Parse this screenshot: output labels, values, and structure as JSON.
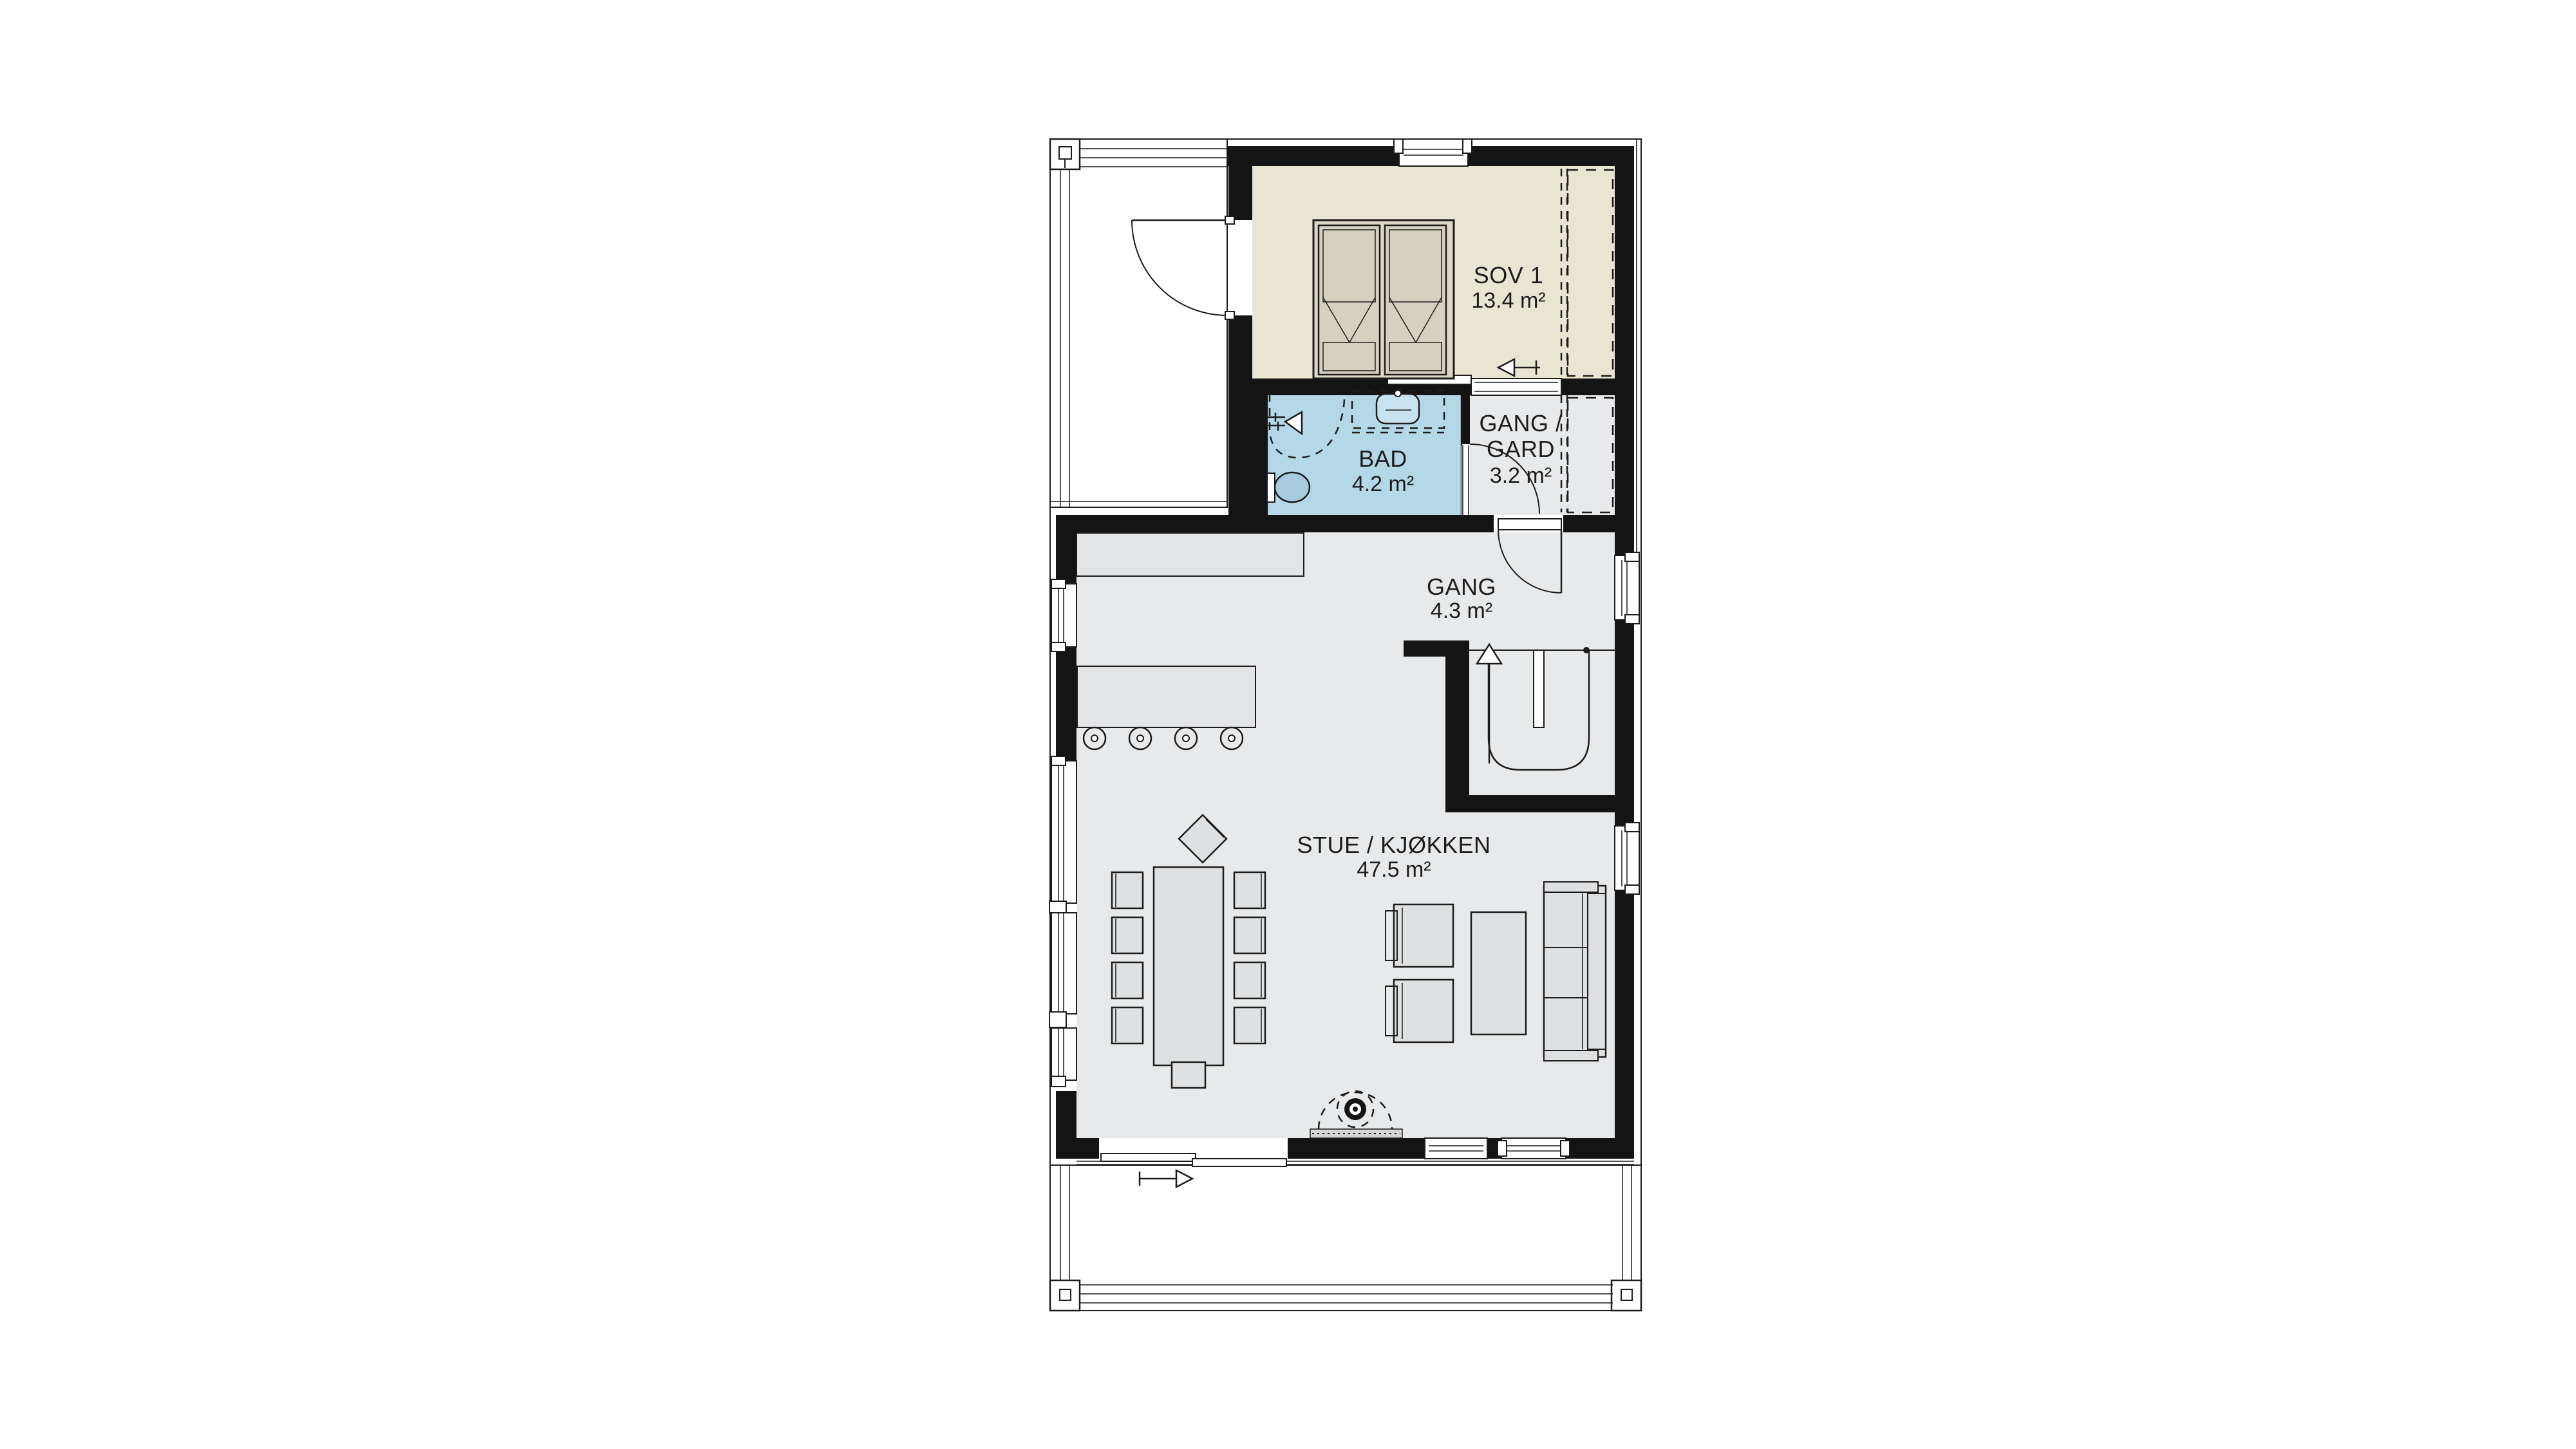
{
  "rooms": {
    "sov1": {
      "name": "SOV 1",
      "area": "13.4 m²"
    },
    "bad": {
      "name": "BAD",
      "area": "4.2 m²"
    },
    "gang_gard": {
      "name_line1": "GANG /",
      "name_line2": "GARD",
      "area": "3.2 m²"
    },
    "gang": {
      "name": "GANG",
      "area": "4.3 m²"
    },
    "stue_kjokken": {
      "name": "STUE / KJØKKEN",
      "area": "47.5 m²"
    }
  },
  "colors": {
    "background": "#ffffff",
    "wall": "#141414",
    "line": "#1c1c1c",
    "bedroom_floor": "#e9e5d3",
    "bathroom_floor": "#b4d8e8",
    "interior_floor": "#e8e9ea",
    "furniture_fill": "#dee0e2",
    "counter_fill": "#e3e4e6",
    "bed_fill": "#dcd7c5",
    "mattress_fill": "#d5d0bf",
    "toilet_fill": "#a6cbdc",
    "sink_fill": "#c9e2ef",
    "hearth_fill": "#d6d6d6"
  }
}
